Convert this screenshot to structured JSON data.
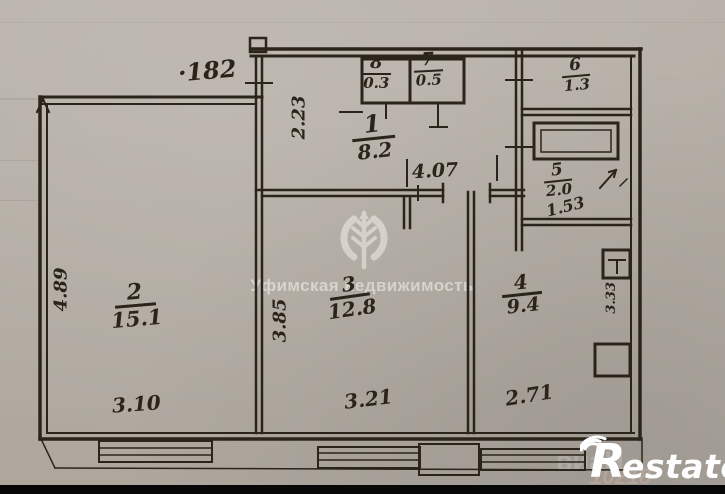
{
  "plan": {
    "rooms": [
      {
        "number": "1",
        "area": "8.2"
      },
      {
        "number": "2",
        "area": "15.1"
      },
      {
        "number": "3",
        "area": "12.8"
      },
      {
        "number": "4",
        "area": "9.4"
      },
      {
        "number": "5",
        "area": "2.0",
        "note": "1.53"
      },
      {
        "number": "6",
        "area": "1.3"
      },
      {
        "number": "7",
        "area": "0.5"
      },
      {
        "number": "8",
        "area": "0.3"
      }
    ],
    "dimensions": {
      "top_width": "·182",
      "entry_height": "2.23",
      "room2_height": "4.89",
      "room3_height": "3.85",
      "hall_length": "4.07",
      "room4_height": "3.33",
      "room2_width": "3.10",
      "room3_width": "3.21",
      "room4_width": "2.71"
    }
  },
  "watermarks": {
    "agency_text": "Уфимская недвижимость",
    "agency_icon": "wheat-ear-icon",
    "logo_r": "R",
    "logo_rest": "estate",
    "faint_1": "виаН",
    "faint_2": "10218"
  },
  "colors": {
    "ink": "#2a241b",
    "paper": "#b3ada4",
    "watermark": "#f7f5f1",
    "bottom_bar": "#070707"
  }
}
